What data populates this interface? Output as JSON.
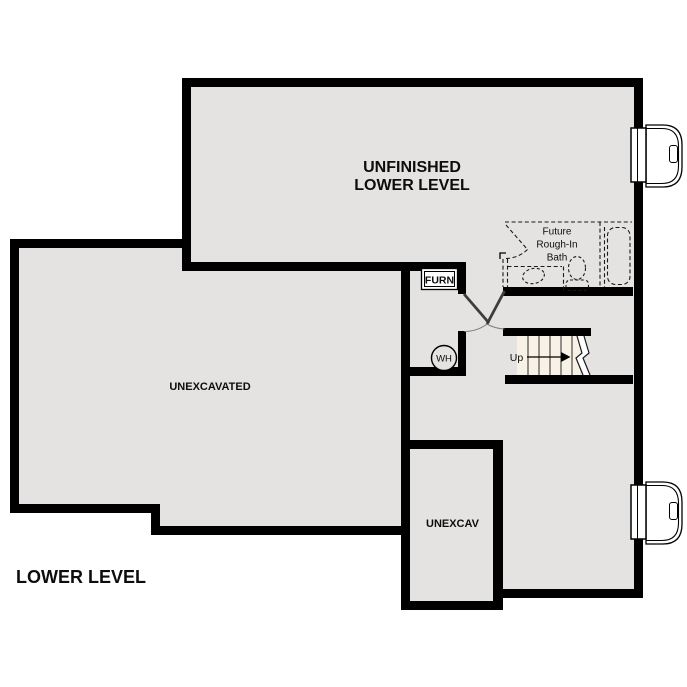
{
  "title": {
    "label": "LOWER LEVEL"
  },
  "colors": {
    "wall": "#000000",
    "floor": "#e4e3e1",
    "stair_fill": "#f7f1e6",
    "background": "#ffffff",
    "door_leaf": "#3d3d3d",
    "door_arc": "#808080",
    "dashed_line": "#1a1a1a"
  },
  "rooms": {
    "unfinished_lower_level": {
      "label_line1": "UNFINISHED",
      "label_line2": "LOWER LEVEL"
    },
    "unexcavated": {
      "label": "UNEXCAVATED"
    },
    "unexcav": {
      "label": "UNEXCAV"
    },
    "furnace": {
      "label": "FURN"
    },
    "water_heater": {
      "label": "WH"
    },
    "future_bath": {
      "line1": "Future",
      "line2": "Rough-In",
      "line3": "Bath"
    },
    "stairs": {
      "up_label": "Up"
    }
  }
}
